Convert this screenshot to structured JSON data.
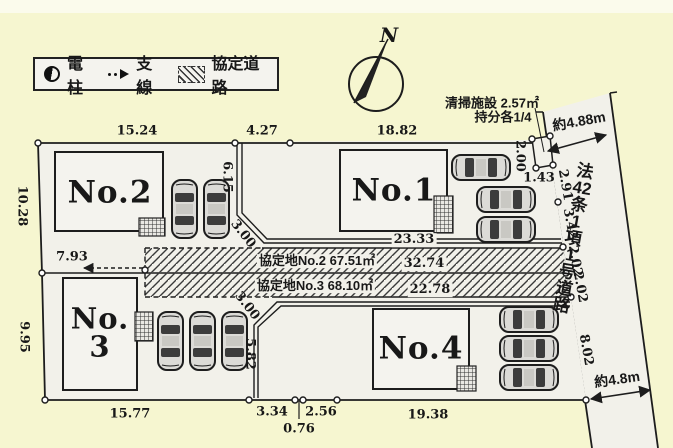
{
  "colors": {
    "background": "#f6f6d0",
    "paper": "#f2f1ea",
    "line": "#1d1d1d"
  },
  "legend": {
    "pole": "電柱",
    "wire": "支線",
    "agreement_road": "協定道路"
  },
  "compass": {
    "north": "N"
  },
  "lots": {
    "no1": "No.1",
    "no2": "No.2",
    "no3_line1": "No.",
    "no3_line2": "3",
    "no4": "No.4"
  },
  "agreement_areas": {
    "row_upper": "協定地No.2 67.51㎡",
    "row_lower": "協定地No.3 68.10㎡"
  },
  "road": {
    "name_chars": [
      "法",
      "42",
      "条",
      "1",
      "項",
      "1",
      "号",
      "道",
      "路"
    ],
    "width_top": "約4.88m",
    "width_bottom": "約4.8m"
  },
  "facility": {
    "line1": "清掃施設 2.57㎡",
    "line2": "持分各1/4"
  },
  "dimensions": {
    "top_no2": "15.24",
    "top_gap": "4.27",
    "top_no1": "18.82",
    "left_no2": "10.28",
    "left_no3": "9.95",
    "mid_no3": "7.93",
    "divider_top_v": "6.15",
    "divider_top_d": "3.00",
    "no1_corridor": "23.33",
    "band_upper": "32.74",
    "band_lower": "22.78",
    "divider_bottom_d": "3.00",
    "divider_bottom_v": "5.82",
    "bottom_no3": "15.77",
    "bottom_a": "3.34",
    "bottom_b": "0.76",
    "bottom_c": "2.56",
    "bottom_no4": "19.38",
    "facility_left": "2.00",
    "facility_bottom": "1.43",
    "road_seg1": "2.91",
    "road_seg2": "3.42",
    "road_seg3": "2.02",
    "road_seg4": "2.02",
    "road_seg5": "8.02"
  }
}
